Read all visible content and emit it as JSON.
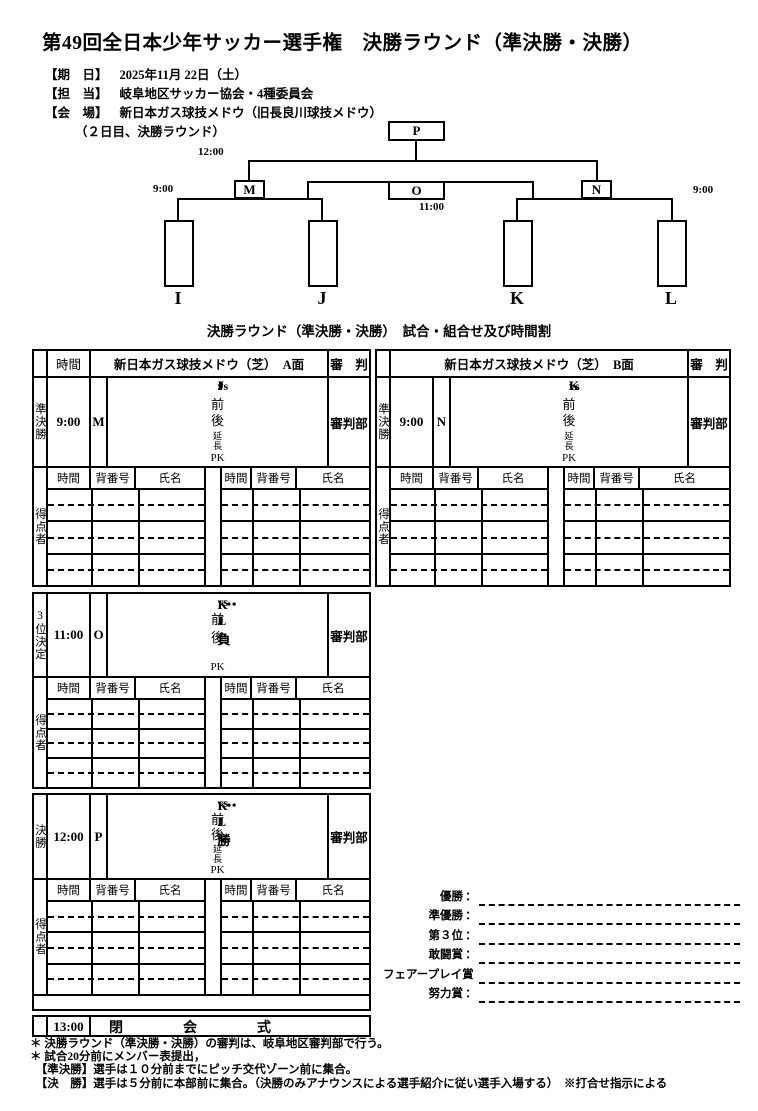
{
  "title": "第49回全日本少年サッカー選手権　決勝ラウンド（準決勝・決勝）",
  "info": {
    "date": {
      "label": "【期　日】",
      "value": "2025年11月 22日（土）"
    },
    "staff": {
      "label": "【担　当】",
      "value": "岐阜地区サッカー協会・4種委員会"
    },
    "venue": {
      "label": "【会　場】",
      "value": "新日本ガス球技メドウ（旧長良川球技メドウ）"
    },
    "venue_note": "（２日目、決勝ラウンド）"
  },
  "bracket": {
    "p": {
      "code": "P",
      "time": "12:00"
    },
    "m": {
      "code": "M",
      "time": "9:00"
    },
    "o": {
      "code": "O",
      "time": "11:00"
    },
    "n": {
      "code": "N",
      "time": "9:00"
    },
    "teams": {
      "i": "I",
      "j": "J",
      "k": "K",
      "l": "L"
    }
  },
  "caption": "決勝ラウンド（準決勝・決勝）　試合・組合せ及び時間割",
  "table": {
    "time_header": "時間",
    "venue_a": "新日本ガス球技メドウ（芝）　A面",
    "venue_b": "新日本ガス球技メドウ（芝）　B面",
    "referee_header": "審　判",
    "referee": "審判部",
    "scorer_label": "得点者",
    "scorer_cols": {
      "time": "時間",
      "number": "背番号",
      "name": "氏名"
    },
    "vs": "vs",
    "semi_a": {
      "stage": "準決勝",
      "time": "9:00",
      "code": "M",
      "home": "I",
      "away": "J",
      "p1": "前",
      "p2": "後",
      "p3": "延長",
      "p4": "PK"
    },
    "semi_b": {
      "stage": "準決勝",
      "time": "9:00",
      "code": "N",
      "home": "K",
      "away": "L",
      "p1": "前",
      "p2": "後",
      "p3": "延長",
      "p4": "PK"
    },
    "third": {
      "stage": "3位決定",
      "time": "11:00",
      "code": "O",
      "home": "I・J負",
      "away": "K・L負",
      "p1": "前",
      "p2": "後",
      "p3": "",
      "p4": "PK"
    },
    "final": {
      "stage": "決勝",
      "time": "12:00",
      "code": "P",
      "home": "I・J勝",
      "away": "K・L勝",
      "p1": "前",
      "p2": "後",
      "p3": "延長",
      "p4": "PK"
    },
    "closing": {
      "time": "13:00",
      "label": "閉　会　式"
    }
  },
  "awards": {
    "colon": "：",
    "items": [
      "優勝",
      "準優勝",
      "第３位",
      "敢闘賞",
      "フェアープレイ賞",
      "努力賞"
    ]
  },
  "notes": [
    "＊ 決勝ラウンド（準決勝・決勝）の審判は、岐阜地区審判部で行う。",
    "＊ 試合20分前にメンバー表提出，",
    "　【準決勝】選手は１０分前までにピッチ交代ゾーン前に集合。",
    "　【決　勝】選手は５分前に本部前に集合。（決勝のみアナウンスによる選手紹介に従い選手入場する）　※打合せ指示による"
  ],
  "colors": {
    "cyan": "#c7eff8",
    "yellow": "#f9f2a0"
  }
}
